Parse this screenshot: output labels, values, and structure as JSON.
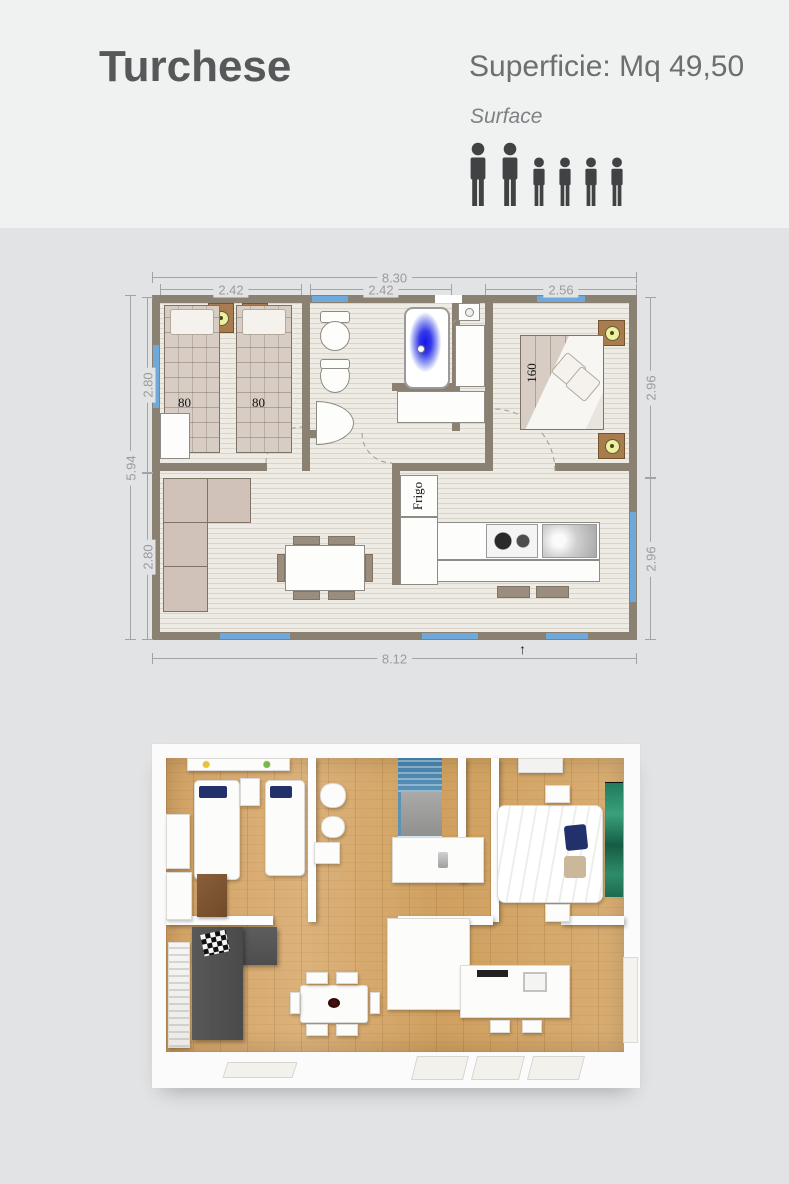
{
  "header": {
    "title": "Turchese",
    "superficie": "Superficie: Mq 49,50",
    "surface_label": "Surface",
    "occupancy_icons": [
      "adult-icon",
      "adult-icon",
      "child-icon",
      "child-icon",
      "child-icon",
      "child-icon"
    ]
  },
  "floorplan_2d": {
    "dimensions": {
      "top_total": "8.30",
      "top_segments": [
        "2.42",
        "2.42",
        "2.56"
      ],
      "left_total": "5.94",
      "left_segments": [
        "2.80",
        "2.80"
      ],
      "right_segments": [
        "2.96",
        "2.96"
      ],
      "bottom_total": "8.12"
    },
    "labels": {
      "bed_single": "80",
      "bed_double": "160",
      "fridge": "Frigo",
      "north_arrow": "↑"
    },
    "colors": {
      "wall": "#8a8173",
      "window_blue": "#6fa9dc",
      "floor": "#edebe3",
      "bathtub_blue": "#1517e6",
      "furniture_beige": "#d8cdc5",
      "wood_accent": "#a97c4f"
    }
  },
  "render_3d": {
    "colors": {
      "wood_floor": "#d4a86d",
      "wall_white": "#fbfbfb",
      "sofa_gray": "#575757",
      "shower_blue": "#4e87ae",
      "wardrobe_green": "#2e8c6a",
      "pillow_navy": "#22306b"
    }
  }
}
